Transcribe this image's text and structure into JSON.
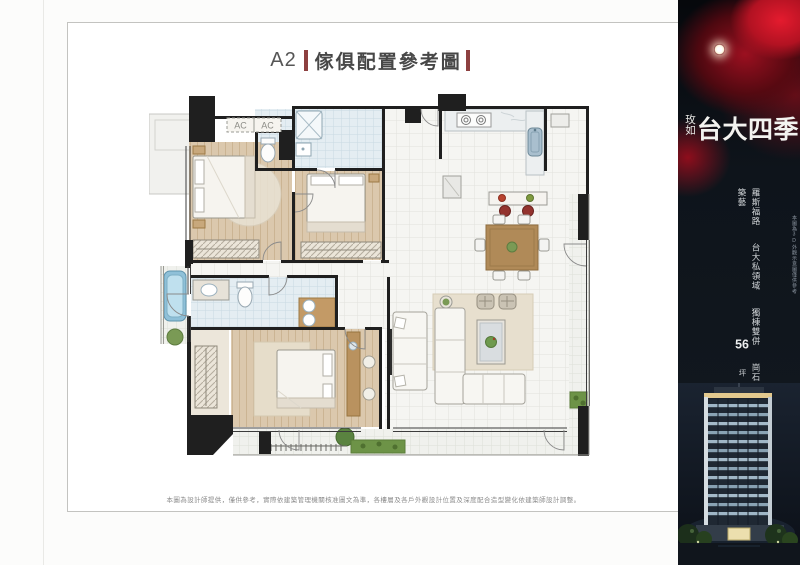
{
  "frame": {
    "title": {
      "code": "A2",
      "text": "傢俱配置參考圖"
    },
    "disclaimer": "本圖為設計師提供，僅供參考，實際依建築管理機關核准圖文為準，各樓層及各戶外觀設計位置及深度配合造型變化依建築師設計調整。"
  },
  "floorplan": {
    "ac_left": "AC",
    "ac_right": "AC"
  },
  "panel": {
    "logo_vertical": "玫如",
    "logo_main": "台大四季",
    "slogan": [
      "羅斯福路",
      "台大私領域",
      "獨棟雙併",
      "崗石築藝"
    ],
    "sizes": [
      {
        "value": "56",
        "unit": "坪"
      },
      {
        "value": "68",
        "unit": "坪"
      }
    ],
    "building_caption": "本圖為3D外觀示意圖僅供參考",
    "colors": {
      "panel_bg": "#0c1117",
      "rose_red": "#c81728",
      "accent_bar": "#8d4040"
    }
  }
}
